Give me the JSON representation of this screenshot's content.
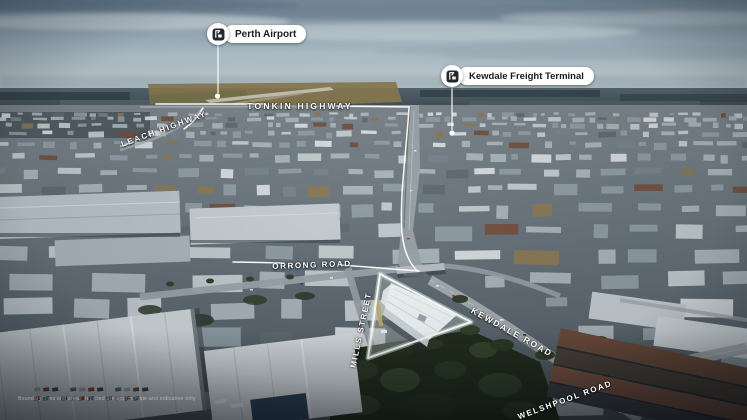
{
  "pins": {
    "perth_airport": {
      "label": "Perth Airport",
      "icon": "freight-building-icon"
    },
    "kewdale_freight_terminal": {
      "label": "Kewdale Freight Terminal",
      "icon": "freight-building-icon"
    }
  },
  "road_labels": {
    "tonkin": "TONKIN HIGHWAY",
    "leach": "LEACH HIGHWAY",
    "orrong": "ORRONG ROAD",
    "mills": "MILLS STREET",
    "kewdale": "KEWDALE ROAD",
    "welshpool": "WELSHPOOL ROAD"
  },
  "property": {
    "name": "highlighted-site-outline",
    "outline_color": "#ffffff"
  },
  "disclaimer": "Boundary lines and areas depicted are approximate and indicative only",
  "colors": {
    "pill_background": "#ffffff",
    "pill_text": "#1b1b1d",
    "icon_badge": "#23282d",
    "annotation_line": "#ffffff",
    "site_outline": "#ffffff"
  }
}
